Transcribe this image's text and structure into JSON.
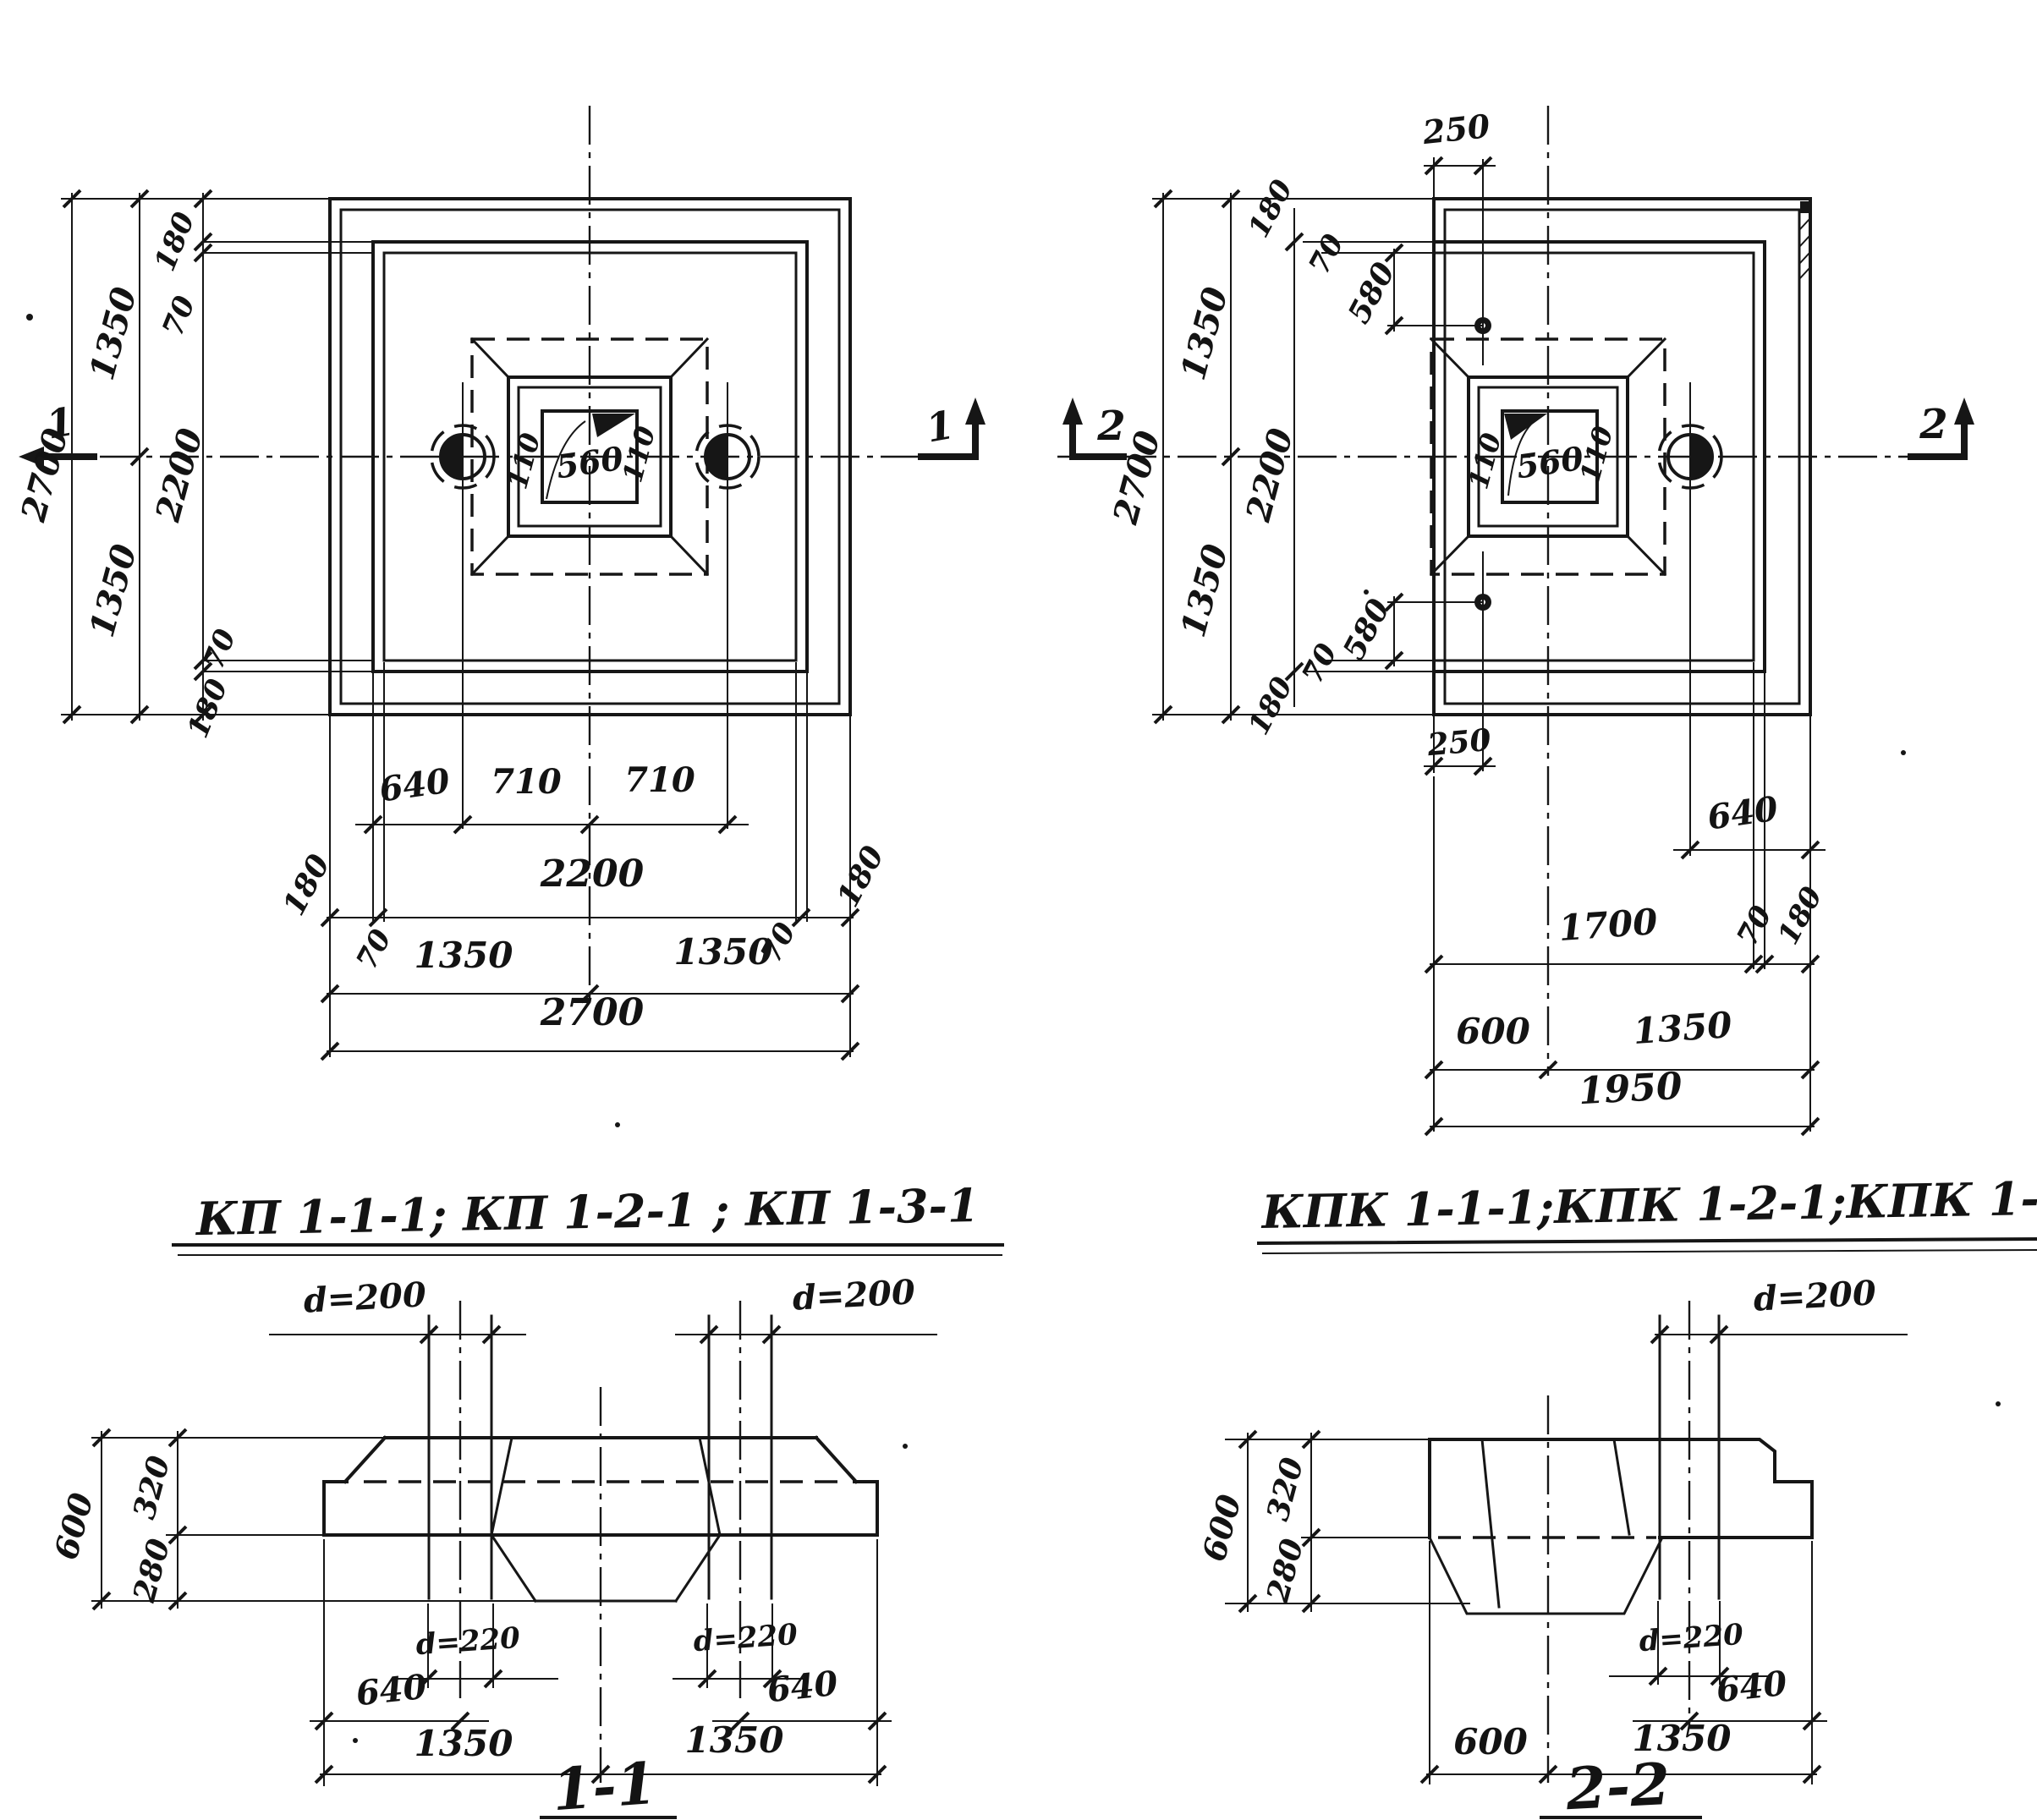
{
  "plan_left": {
    "marker": "1",
    "left_dims": {
      "total": "2700",
      "half_top": "1350",
      "half_bot": "1350",
      "mid": "2200",
      "edge_top": "180",
      "off_top": "70",
      "off_bot": "70",
      "edge_bot": "180"
    },
    "socket": {
      "l": "110",
      "c": "560",
      "r": "110"
    },
    "bottom_dims": {
      "a1": "640",
      "a2": "710",
      "a3": "710",
      "b1": "180",
      "b2": "2200",
      "b3": "180",
      "b1o": "70",
      "b3o": "70",
      "c1": "1350",
      "c2": "1350",
      "d": "2700"
    }
  },
  "plan_right": {
    "marker": "2",
    "top_dims": {
      "bolt": "250",
      "edge": "180",
      "off": "70",
      "drop": "580"
    },
    "left_dims": {
      "total": "2700",
      "half_top": "1350",
      "half_bot": "1350",
      "mid": "2200"
    },
    "socket": {
      "l": "110",
      "c": "560",
      "r": "110"
    },
    "bot_leader": {
      "drop": "580",
      "off": "70",
      "edge": "180",
      "bolt": "250"
    },
    "bottom_dims": {
      "a": "640",
      "b1": "1700",
      "b2": "70",
      "b3": "180",
      "c1": "600",
      "c2": "1350",
      "d": "1950"
    }
  },
  "titles": {
    "left": "КП 1-1-1; КП 1-2-1 ; КП 1-3-1",
    "right": "КПК 1-1-1;КПК 1-2-1;КПК 1-3-1"
  },
  "section_1": {
    "title": "1-1",
    "d200_l": "d=200",
    "d200_r": "d=200",
    "d220_l": "d=220",
    "d220_r": "d=220",
    "h_total": "600",
    "h_top": "320",
    "h_bot": "280",
    "w640_l": "640",
    "w640_r": "640",
    "w1350_l": "1350",
    "w1350_r": "1350"
  },
  "section_2": {
    "title": "2-2",
    "d200": "d=200",
    "d220": "d=220",
    "h_total": "600",
    "h_top": "320",
    "h_bot": "280",
    "w640": "640",
    "w600": "600",
    "w1350": "1350"
  }
}
